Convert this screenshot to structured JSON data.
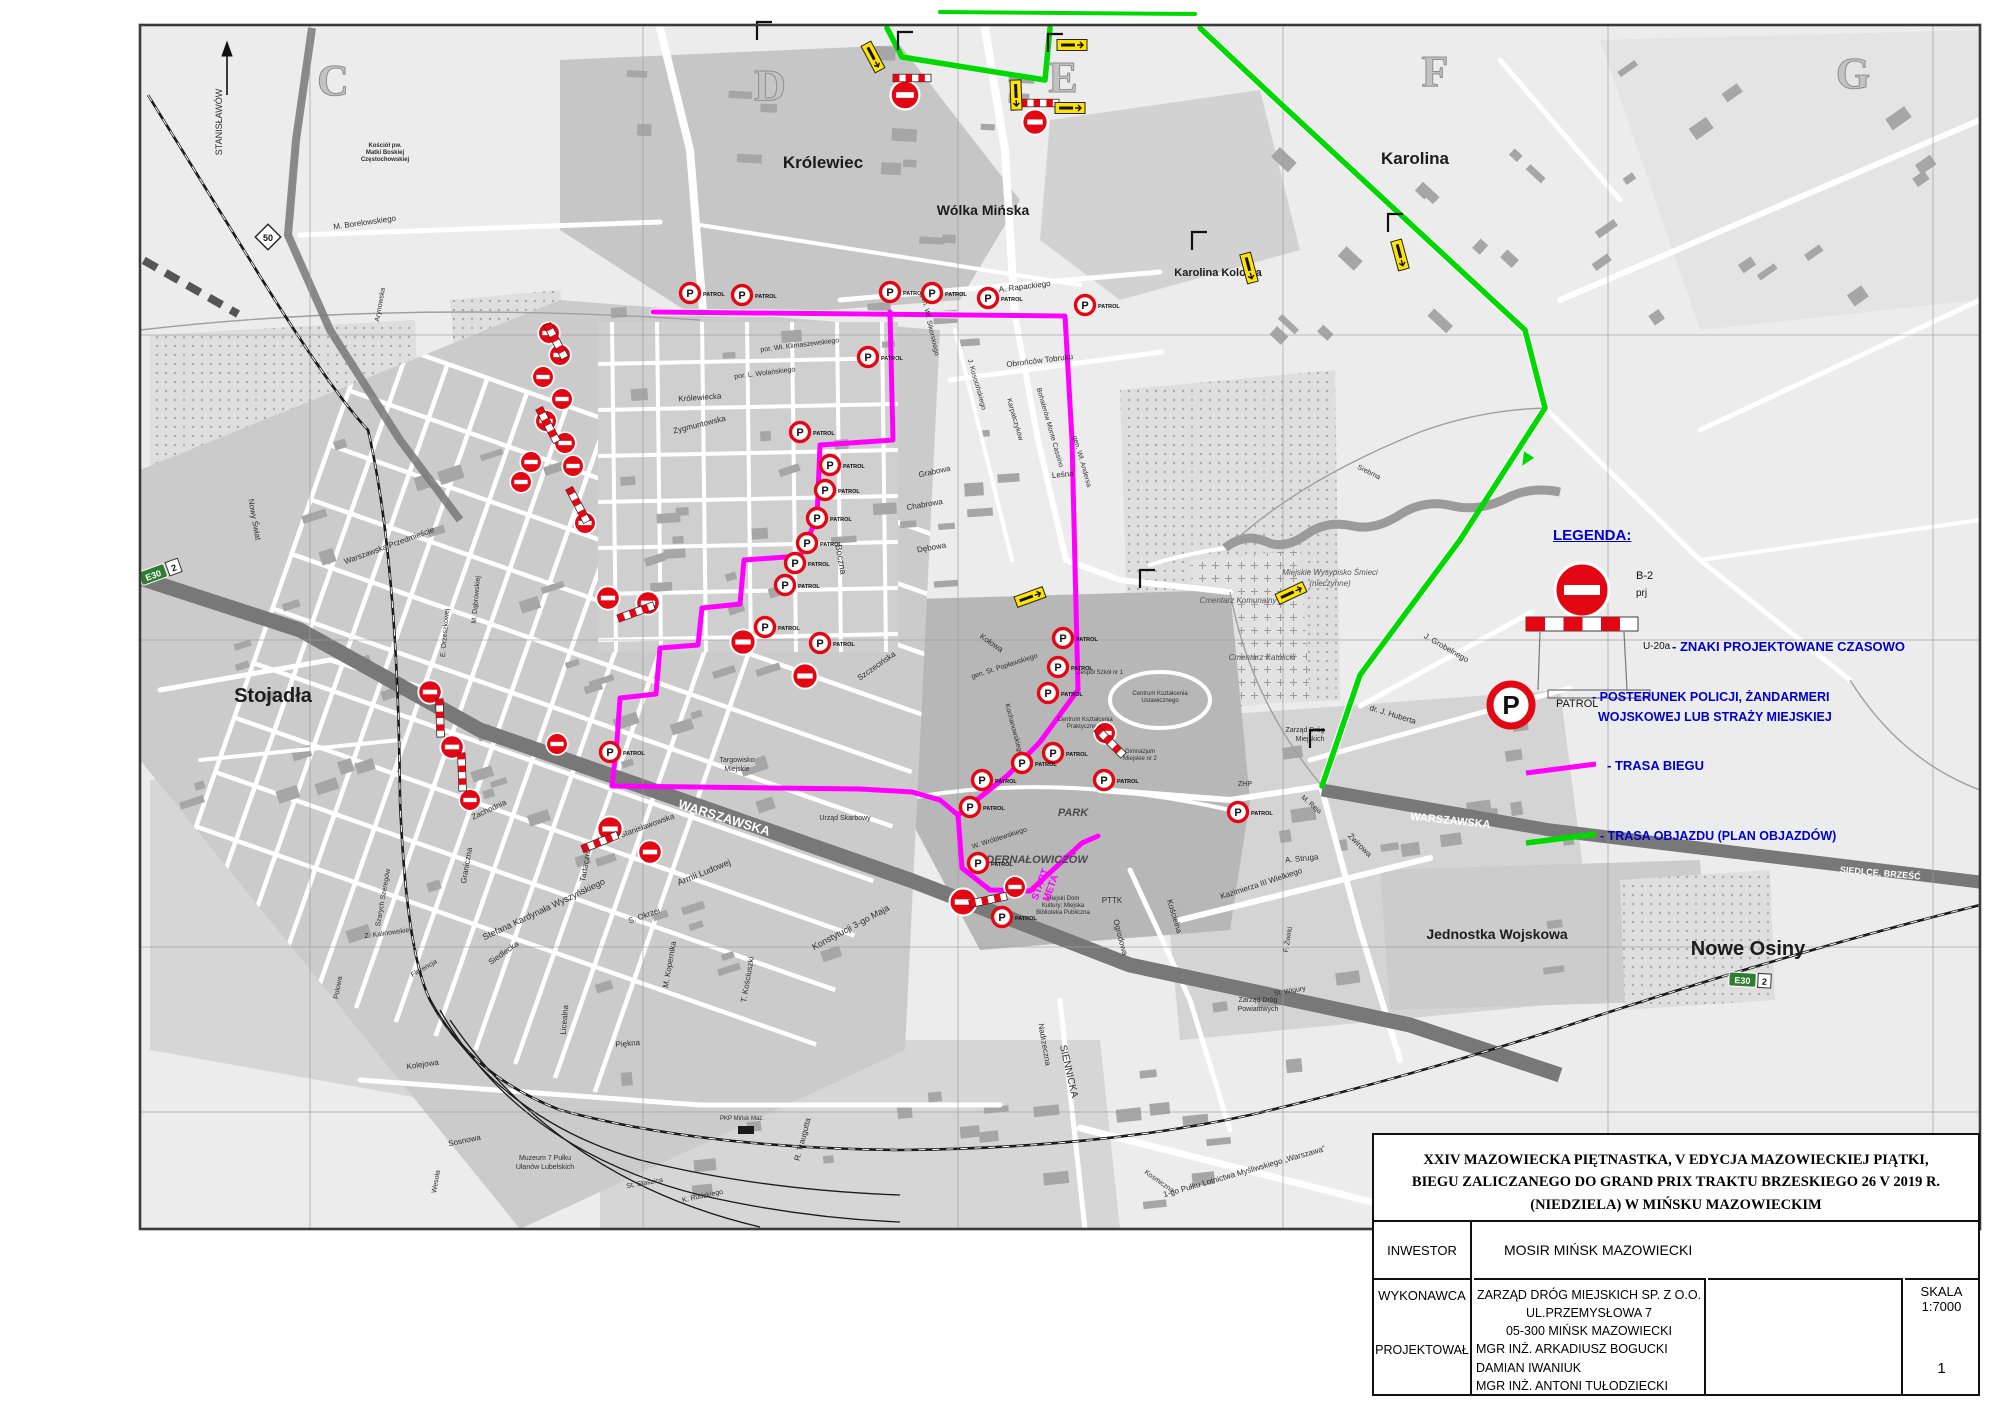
{
  "colors": {
    "route_run": "#ff00ff",
    "route_detour": "#00d900",
    "legend_blue": "#0000cd",
    "sign_red": "#e30613",
    "road_dark": "#787878",
    "detour_yellow": "#ffe400"
  },
  "legend": {
    "title": "LEGENDA:",
    "b2_label": "B-2",
    "b2_sub": "prj",
    "u20a_label": "U-20a",
    "item_signs": "- ZNAKI PROJEKTOWANE CZASOWO",
    "patrol_label": "PATROL",
    "item_patrol_1": "- POSTERUNEK POLICJI, ŻANDARMERI",
    "item_patrol_2": "WOJSKOWEJ LUB STRAŻY MIEJSKIEJ",
    "item_route": "- TRASA BIEGU",
    "item_detour": "- TRASA OBJAZDU (PLAN OBJAZDÓW)"
  },
  "title_block": {
    "title_line1": "XXIV MAZOWIECKA PIĘTNASTKA, V EDYCJA MAZOWIECKIEJ PIĄTKI,",
    "title_line2": "BIEGU ZALICZANEGO DO GRAND PRIX TRAKTU BRZESKIEGO 26 V 2019 R.",
    "title_line3": "(NIEDZIELA) W MIŃSKU MAZOWIECKIM",
    "inwestor_label": "INWESTOR",
    "inwestor_value": "MOSIR MIŃSK MAZOWIECKI",
    "wykonawca_label": "WYKONAWCA",
    "projektowal_label": "PROJEKTOWAŁ",
    "wykonawca_lines": [
      "ZARZĄD DRÓG MIEJSKICH SP. Z O.O.",
      "UL.PRZEMYSŁOWA 7",
      "05-300 MIŃSK MAZOWIECKI"
    ],
    "projektowal_lines": [
      "MGR INŻ. ARKADIUSZ BOGUCKI",
      "DAMIAN IWANIUK",
      "MGR INŻ. ANTONI TUŁODZIECKI"
    ],
    "skala_label": "SKALA",
    "skala_value": "1:7000",
    "sheet_number": "1"
  },
  "map": {
    "patrol_word": "PATROL",
    "start_label": "START",
    "meta_label": "META",
    "badge_e30": "E30",
    "badge_2": "2",
    "badge_50": "50",
    "grid_letters": [
      {
        "t": "C",
        "x": 333,
        "y": 95
      },
      {
        "t": "D",
        "x": 770,
        "y": 100
      },
      {
        "t": "E",
        "x": 1063,
        "y": 92
      },
      {
        "t": "F",
        "x": 1435,
        "y": 86
      },
      {
        "t": "G",
        "x": 1853,
        "y": 88
      }
    ],
    "towns": [
      {
        "t": "Królewiec",
        "x": 823,
        "y": 168,
        "s": 17
      },
      {
        "t": "Wólka Mińska",
        "x": 983,
        "y": 215,
        "s": 14
      },
      {
        "t": "Karolina",
        "x": 1415,
        "y": 164,
        "s": 17
      },
      {
        "t": "Karolina Kolonia",
        "x": 1218,
        "y": 276,
        "s": 11
      },
      {
        "t": "Stojadła",
        "x": 273,
        "y": 702,
        "s": 20
      },
      {
        "t": "Nowe Osiny",
        "x": 1748,
        "y": 955,
        "s": 20
      },
      {
        "t": "Jednostka Wojskowa",
        "x": 1497,
        "y": 939,
        "s": 14
      }
    ],
    "labels": [
      {
        "t": "M. Borelowskiego",
        "x": 365,
        "y": 225,
        "r": -8
      },
      {
        "t": "Arynowska",
        "x": 382,
        "y": 305,
        "r": -80,
        "s": 7
      },
      {
        "t": "A. Rapackiego",
        "x": 1025,
        "y": 289,
        "r": -7
      },
      {
        "t": "por. Wł. Klimaszewskiego",
        "x": 800,
        "y": 347,
        "r": -7,
        "s": 7
      },
      {
        "t": "por. L. Wolańskiego",
        "x": 765,
        "y": 375,
        "r": -7,
        "s": 7
      },
      {
        "t": "gen. Wł. Sikorskiego",
        "x": 928,
        "y": 325,
        "r": 77,
        "s": 7
      },
      {
        "t": "J. Kusocińskiego",
        "x": 975,
        "y": 385,
        "r": 74,
        "s": 7
      },
      {
        "t": "Karpatczyków",
        "x": 1013,
        "y": 420,
        "r": 74,
        "s": 7
      },
      {
        "t": "Bohaterów Monte Cassino",
        "x": 1048,
        "y": 428,
        "r": 74,
        "s": 7
      },
      {
        "t": "gen. Wł. Andersa",
        "x": 1080,
        "y": 462,
        "r": 74,
        "s": 7
      },
      {
        "t": "Obrońców Tobruku",
        "x": 1040,
        "y": 363,
        "r": -7
      },
      {
        "t": "Leśna",
        "x": 1063,
        "y": 477,
        "r": -5
      },
      {
        "t": "Grabowa",
        "x": 935,
        "y": 474,
        "r": -12
      },
      {
        "t": "Chabrowa",
        "x": 925,
        "y": 507,
        "r": -10
      },
      {
        "t": "Dębowa",
        "x": 932,
        "y": 550,
        "r": -10
      },
      {
        "t": "Boczna",
        "x": 838,
        "y": 560,
        "r": 80,
        "s": 9
      },
      {
        "t": "Szczecińska",
        "x": 878,
        "y": 668,
        "r": -35
      },
      {
        "t": "Królewiecka",
        "x": 700,
        "y": 400,
        "r": -4
      },
      {
        "t": "Zygmuntowska",
        "x": 700,
        "y": 427,
        "r": -14
      },
      {
        "t": "Kołowa",
        "x": 990,
        "y": 645,
        "r": 35
      },
      {
        "t": "gen. St. Popławskiego",
        "x": 1005,
        "y": 668,
        "r": -18,
        "s": 7
      },
      {
        "t": "Kochanowskiego",
        "x": 1012,
        "y": 730,
        "r": 75,
        "s": 7
      },
      {
        "t": "Warszawska Przedmieście",
        "x": 390,
        "y": 548,
        "r": -20
      },
      {
        "t": "Nowy Świat",
        "x": 252,
        "y": 520,
        "r": 80
      },
      {
        "t": "Stanisławowska",
        "x": 648,
        "y": 828,
        "r": -20
      },
      {
        "t": "WARSZAWSKA",
        "x": 723,
        "y": 822,
        "r": 17,
        "s": 13,
        "w": 1,
        "b": 1
      },
      {
        "t": "WARSZAWSKA",
        "x": 1450,
        "y": 824,
        "r": 6,
        "s": 11,
        "w": 1,
        "b": 1
      },
      {
        "t": "SIEDLCE, BRZEŚĆ",
        "x": 1880,
        "y": 876,
        "r": 5,
        "s": 9,
        "w": 1,
        "b": 1
      },
      {
        "t": "Stefana Kardynała Wyszyńskiego",
        "x": 545,
        "y": 912,
        "r": -25,
        "s": 9
      },
      {
        "t": "Armii Ludowej",
        "x": 705,
        "y": 875,
        "r": -22,
        "s": 9
      },
      {
        "t": "Konstytucji 3-go Maja",
        "x": 852,
        "y": 930,
        "r": -28,
        "s": 9
      },
      {
        "t": "T. Kościuszki",
        "x": 750,
        "y": 980,
        "r": -80
      },
      {
        "t": "S. Okrzei",
        "x": 645,
        "y": 918,
        "r": -20
      },
      {
        "t": "M. Kopernika",
        "x": 672,
        "y": 965,
        "r": -80
      },
      {
        "t": "Tartaczna",
        "x": 588,
        "y": 865,
        "r": -80
      },
      {
        "t": "Zachodnia",
        "x": 490,
        "y": 812,
        "r": -25
      },
      {
        "t": "Graniczna",
        "x": 469,
        "y": 866,
        "r": -80
      },
      {
        "t": "Siedlecka",
        "x": 505,
        "y": 955,
        "r": -35
      },
      {
        "t": "Licealna",
        "x": 567,
        "y": 1020,
        "r": -85
      },
      {
        "t": "Piękna",
        "x": 628,
        "y": 1046,
        "r": -5
      },
      {
        "t": "Z. Kalinowskiej",
        "x": 388,
        "y": 935,
        "r": -8,
        "s": 7
      },
      {
        "t": "Florencja",
        "x": 425,
        "y": 970,
        "r": -30,
        "s": 7
      },
      {
        "t": "Polowa",
        "x": 340,
        "y": 988,
        "r": -80,
        "s": 7
      },
      {
        "t": "Szarych Szeregów",
        "x": 385,
        "y": 898,
        "r": -80,
        "s": 7
      },
      {
        "t": "Kolejowa",
        "x": 423,
        "y": 1067,
        "r": -8
      },
      {
        "t": "Sosnowa",
        "x": 465,
        "y": 1143,
        "r": -12
      },
      {
        "t": "Wesoła",
        "x": 438,
        "y": 1182,
        "r": -80,
        "s": 7
      },
      {
        "t": "R. Traugutta",
        "x": 805,
        "y": 1140,
        "r": -75
      },
      {
        "t": "K. Rudzkiego",
        "x": 703,
        "y": 1198,
        "r": -12,
        "s": 7
      },
      {
        "t": "St. Staszica",
        "x": 645,
        "y": 1185,
        "r": -10,
        "s": 7
      },
      {
        "t": "SIENNICKA",
        "x": 1066,
        "y": 1072,
        "r": 77,
        "s": 10
      },
      {
        "t": "Nadrzeczna",
        "x": 1042,
        "y": 1045,
        "r": 80
      },
      {
        "t": "Ogrodowa",
        "x": 1118,
        "y": 938,
        "r": 75
      },
      {
        "t": "Kościelna",
        "x": 1172,
        "y": 917,
        "r": 73
      },
      {
        "t": "Kazimierza III Wielkiego",
        "x": 1262,
        "y": 886,
        "r": -18
      },
      {
        "t": "1-go Pułku Lotnictwa Myśliwskiego „Warszawa”",
        "x": 1245,
        "y": 1174,
        "r": -16
      },
      {
        "t": "Kosmiczna",
        "x": 1158,
        "y": 1183,
        "r": 35,
        "s": 7
      },
      {
        "t": "J. Grobelnego",
        "x": 1445,
        "y": 650,
        "r": 30
      },
      {
        "t": "Srebrna",
        "x": 1368,
        "y": 474,
        "r": 27,
        "s": 7
      },
      {
        "t": "dr. J. Huberta",
        "x": 1392,
        "y": 717,
        "r": 17
      },
      {
        "t": "Żwirowa",
        "x": 1358,
        "y": 847,
        "r": 45
      },
      {
        "t": "M. Reja",
        "x": 1310,
        "y": 806,
        "r": 40,
        "s": 7
      },
      {
        "t": "A. Struga",
        "x": 1302,
        "y": 861,
        "r": -6
      },
      {
        "t": "F. Żwirki",
        "x": 1290,
        "y": 940,
        "r": -80,
        "s": 7
      },
      {
        "t": "St. Wigury",
        "x": 1290,
        "y": 993,
        "r": -10,
        "s": 7
      },
      {
        "t": "E. Orzeszkowej",
        "x": 447,
        "y": 633,
        "r": -85,
        "s": 7
      },
      {
        "t": "M. Dąbrowskiej",
        "x": 478,
        "y": 600,
        "r": -85,
        "s": 7
      },
      {
        "t": "PARK",
        "x": 1073,
        "y": 816,
        "b": 1,
        "i": 1,
        "s": 11,
        "c": "#4a4a4a"
      },
      {
        "t": "DERNAŁOWICZÓW",
        "x": 1037,
        "y": 863,
        "b": 1,
        "i": 1,
        "s": 11,
        "c": "#4a4a4a"
      },
      {
        "t": "W. Wróblewskiego",
        "x": 1000,
        "y": 840,
        "r": -18,
        "s": 7
      },
      {
        "t": "PTTK",
        "x": 1112,
        "y": 903,
        "s": 8
      },
      {
        "t": "Cmentarz Komunalny",
        "x": 1238,
        "y": 603,
        "i": 1,
        "s": 8,
        "c": "#555"
      },
      {
        "t": "Cmentarz Katolicki",
        "x": 1262,
        "y": 660,
        "i": 1,
        "s": 8,
        "c": "#555"
      },
      {
        "t": "Miejskie Wysypisko Śmieci",
        "x": 1330,
        "y": 575,
        "i": 1,
        "s": 8,
        "c": "#555"
      },
      {
        "t": "(nieczynne)",
        "x": 1330,
        "y": 586,
        "i": 1,
        "s": 8,
        "c": "#555"
      },
      {
        "t": "Zarząd Dróg",
        "x": 1305,
        "y": 732,
        "s": 7
      },
      {
        "t": "Miejskich",
        "x": 1310,
        "y": 741,
        "s": 7
      },
      {
        "t": "Zarząd Dróg",
        "x": 1258,
        "y": 1002,
        "s": 7
      },
      {
        "t": "Powiatowych",
        "x": 1258,
        "y": 1011,
        "s": 7
      },
      {
        "t": "Kościół pw.",
        "x": 385,
        "y": 147,
        "s": 6,
        "b": 1
      },
      {
        "t": "Matki Boskiej",
        "x": 385,
        "y": 154,
        "s": 6,
        "b": 1
      },
      {
        "t": "Częstochowskiej",
        "x": 385,
        "y": 161,
        "s": 6,
        "b": 1
      },
      {
        "t": "ZHP",
        "x": 1245,
        "y": 786,
        "s": 7
      },
      {
        "t": "Targowisko",
        "x": 737,
        "y": 762,
        "s": 7
      },
      {
        "t": "Miejskie",
        "x": 737,
        "y": 771,
        "s": 7
      },
      {
        "t": "Urząd Skarbowy",
        "x": 845,
        "y": 820,
        "s": 7
      },
      {
        "t": "Muzeum 7 Pułku",
        "x": 545,
        "y": 1160,
        "s": 7
      },
      {
        "t": "Ułanów Lubelskich",
        "x": 545,
        "y": 1169,
        "s": 7
      },
      {
        "t": "Miejski Dom",
        "x": 1063,
        "y": 900,
        "s": 6
      },
      {
        "t": "Kultury; Miejska",
        "x": 1063,
        "y": 907,
        "s": 6
      },
      {
        "t": "Biblioteka Publiczna",
        "x": 1063,
        "y": 914,
        "s": 6
      },
      {
        "t": "Zespół Szkół nr 1",
        "x": 1100,
        "y": 674,
        "s": 6
      },
      {
        "t": "Centrum Kształcenia",
        "x": 1160,
        "y": 695,
        "s": 6
      },
      {
        "t": "Ustawicznego",
        "x": 1160,
        "y": 702,
        "s": 6
      },
      {
        "t": "Centrum Kształcenia",
        "x": 1085,
        "y": 721,
        "s": 6
      },
      {
        "t": "Praktycznego",
        "x": 1085,
        "y": 728,
        "s": 6
      },
      {
        "t": "Gimnazjum",
        "x": 1140,
        "y": 753,
        "s": 6
      },
      {
        "t": "Miejskie nr 2",
        "x": 1140,
        "y": 760,
        "s": 6
      },
      {
        "t": "PKP Mińsk Maz.",
        "x": 742,
        "y": 1120,
        "s": 6
      },
      {
        "t": "STANISŁAWÓW",
        "x": 222,
        "y": 122,
        "r": -90,
        "s": 9
      }
    ],
    "patrols": [
      [
        690,
        293
      ],
      [
        742,
        295
      ],
      [
        890,
        292
      ],
      [
        932,
        293
      ],
      [
        988,
        298
      ],
      [
        1085,
        305
      ],
      [
        868,
        357
      ],
      [
        800,
        432
      ],
      [
        830,
        465
      ],
      [
        825,
        490
      ],
      [
        817,
        518
      ],
      [
        807,
        543
      ],
      [
        795,
        563
      ],
      [
        785,
        585
      ],
      [
        765,
        627
      ],
      [
        820,
        643
      ],
      [
        610,
        752
      ],
      [
        1063,
        638
      ],
      [
        1058,
        667
      ],
      [
        1048,
        693
      ],
      [
        1053,
        753
      ],
      [
        1022,
        763
      ],
      [
        982,
        780
      ],
      [
        970,
        807
      ],
      [
        978,
        863
      ],
      [
        1104,
        780
      ],
      [
        1238,
        812
      ],
      [
        1002,
        917
      ]
    ],
    "no_entry": [
      [
        905,
        95,
        1.6
      ],
      [
        1035,
        122,
        1.4
      ],
      [
        549,
        333,
        1.2
      ],
      [
        560,
        355,
        1.2
      ],
      [
        543,
        377,
        1.2
      ],
      [
        562,
        399,
        1.2
      ],
      [
        546,
        421,
        1.2
      ],
      [
        565,
        443,
        1.2
      ],
      [
        531,
        462,
        1.2
      ],
      [
        573,
        466,
        1.2
      ],
      [
        521,
        482,
        1.2
      ],
      [
        585,
        523,
        1.2
      ],
      [
        608,
        598,
        1.3
      ],
      [
        648,
        603,
        1.3
      ],
      [
        743,
        642,
        1.4
      ],
      [
        805,
        676,
        1.4
      ],
      [
        430,
        692,
        1.3
      ],
      [
        452,
        747,
        1.3
      ],
      [
        557,
        744,
        1.2
      ],
      [
        470,
        800,
        1.2
      ],
      [
        610,
        829,
        1.4
      ],
      [
        650,
        852,
        1.3
      ],
      [
        963,
        902,
        1.5
      ],
      [
        1015,
        887,
        1.2
      ],
      [
        1105,
        733,
        1.2
      ]
    ],
    "barriers": [
      [
        912,
        78,
        0
      ],
      [
        1040,
        103,
        0
      ],
      [
        556,
        341,
        62
      ],
      [
        548,
        425,
        62
      ],
      [
        578,
        505,
        62
      ],
      [
        636,
        612,
        -20
      ],
      [
        440,
        718,
        88
      ],
      [
        462,
        772,
        88
      ],
      [
        600,
        842,
        -22
      ],
      [
        988,
        900,
        -12
      ],
      [
        1110,
        742,
        45
      ]
    ],
    "detour_signs": [
      [
        873,
        57,
        62
      ],
      [
        1016,
        95,
        88
      ],
      [
        1072,
        45,
        0
      ],
      [
        1070,
        108,
        0
      ],
      [
        1249,
        268,
        75
      ],
      [
        1291,
        593,
        -25
      ],
      [
        1030,
        597,
        -20
      ],
      [
        1400,
        255,
        75
      ]
    ],
    "brackets": [
      [
        757,
        40
      ],
      [
        898,
        50
      ],
      [
        1048,
        52
      ],
      [
        1192,
        250
      ],
      [
        1140,
        588
      ],
      [
        1310,
        748
      ],
      [
        1388,
        232
      ]
    ]
  },
  "routes": {
    "run_outer": [
      [
        653,
        312
      ],
      [
        1065,
        316
      ],
      [
        1072,
        440
      ],
      [
        1078,
        690
      ],
      [
        1040,
        742
      ],
      [
        1008,
        775
      ],
      [
        958,
        815
      ],
      [
        962,
        868
      ],
      [
        990,
        890
      ],
      [
        1030,
        891
      ],
      [
        1055,
        868
      ],
      [
        1082,
        843
      ],
      [
        1098,
        836
      ]
    ],
    "run_inner": [
      [
        890,
        312
      ],
      [
        893,
        440
      ],
      [
        820,
        445
      ],
      [
        817,
        518
      ],
      [
        800,
        556
      ],
      [
        744,
        560
      ],
      [
        740,
        604
      ],
      [
        702,
        608
      ],
      [
        698,
        645
      ],
      [
        660,
        648
      ],
      [
        656,
        694
      ],
      [
        620,
        698
      ],
      [
        617,
        741
      ],
      [
        612,
        786
      ],
      [
        860,
        789
      ],
      [
        912,
        792
      ],
      [
        940,
        800
      ],
      [
        958,
        815
      ]
    ],
    "detour_a": [
      [
        887,
        28
      ],
      [
        902,
        57
      ],
      [
        1045,
        80
      ],
      [
        1050,
        28
      ]
    ],
    "detour_top": [
      [
        940,
        12
      ],
      [
        1195,
        14
      ]
    ],
    "detour_b": [
      [
        1200,
        28
      ],
      [
        1280,
        103
      ],
      [
        1525,
        330
      ],
      [
        1545,
        408
      ],
      [
        1460,
        540
      ],
      [
        1360,
        675
      ],
      [
        1322,
        786
      ]
    ]
  }
}
